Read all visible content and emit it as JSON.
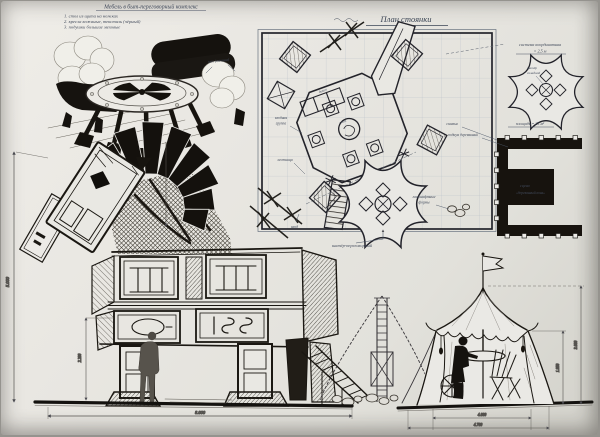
{
  "sheet": {
    "header": {
      "title": "Мебель в быт-переговорный комплекс",
      "items": [
        "1. стол из щита на ножках",
        "2. кресла кожаные, текстиль (чёрный)",
        "3. подушки большие меховые"
      ],
      "fur_note": "мех (овчина)"
    },
    "plan": {
      "title": "План стоянки",
      "labels": {
        "system1": "система координатная",
        "system2": "= 2,5 м",
        "area": "площадь = 25 м²",
        "bench": "скамья",
        "podium": "подиум деревянный",
        "stage1": "сцена",
        "stage2": "«деревянный конь»",
        "tent": "шатёр-переговорный",
        "landscape1": "ландшафтные",
        "landscape2": "формы",
        "entry1": "входная",
        "entry2": "группа",
        "stairs": "лестница",
        "sofa": "диван",
        "table": "стол",
        "entrance": "вход",
        "tr_tent1": "шатёр",
        "tr_tent2": "складной"
      }
    },
    "dimensions": {
      "height": "5.000",
      "leg_height": "2.200",
      "length": "8.000",
      "tent_inner_height": "1.950",
      "tent_height": "3.000",
      "tent_inner_width": "4.000",
      "tent_width": "4.700"
    },
    "colors": {
      "paper": "#e9e7e2",
      "ink": "#17140f",
      "pencil": "#3c3a38",
      "blueprint": "#465260",
      "grid": "#b2bac2"
    }
  }
}
